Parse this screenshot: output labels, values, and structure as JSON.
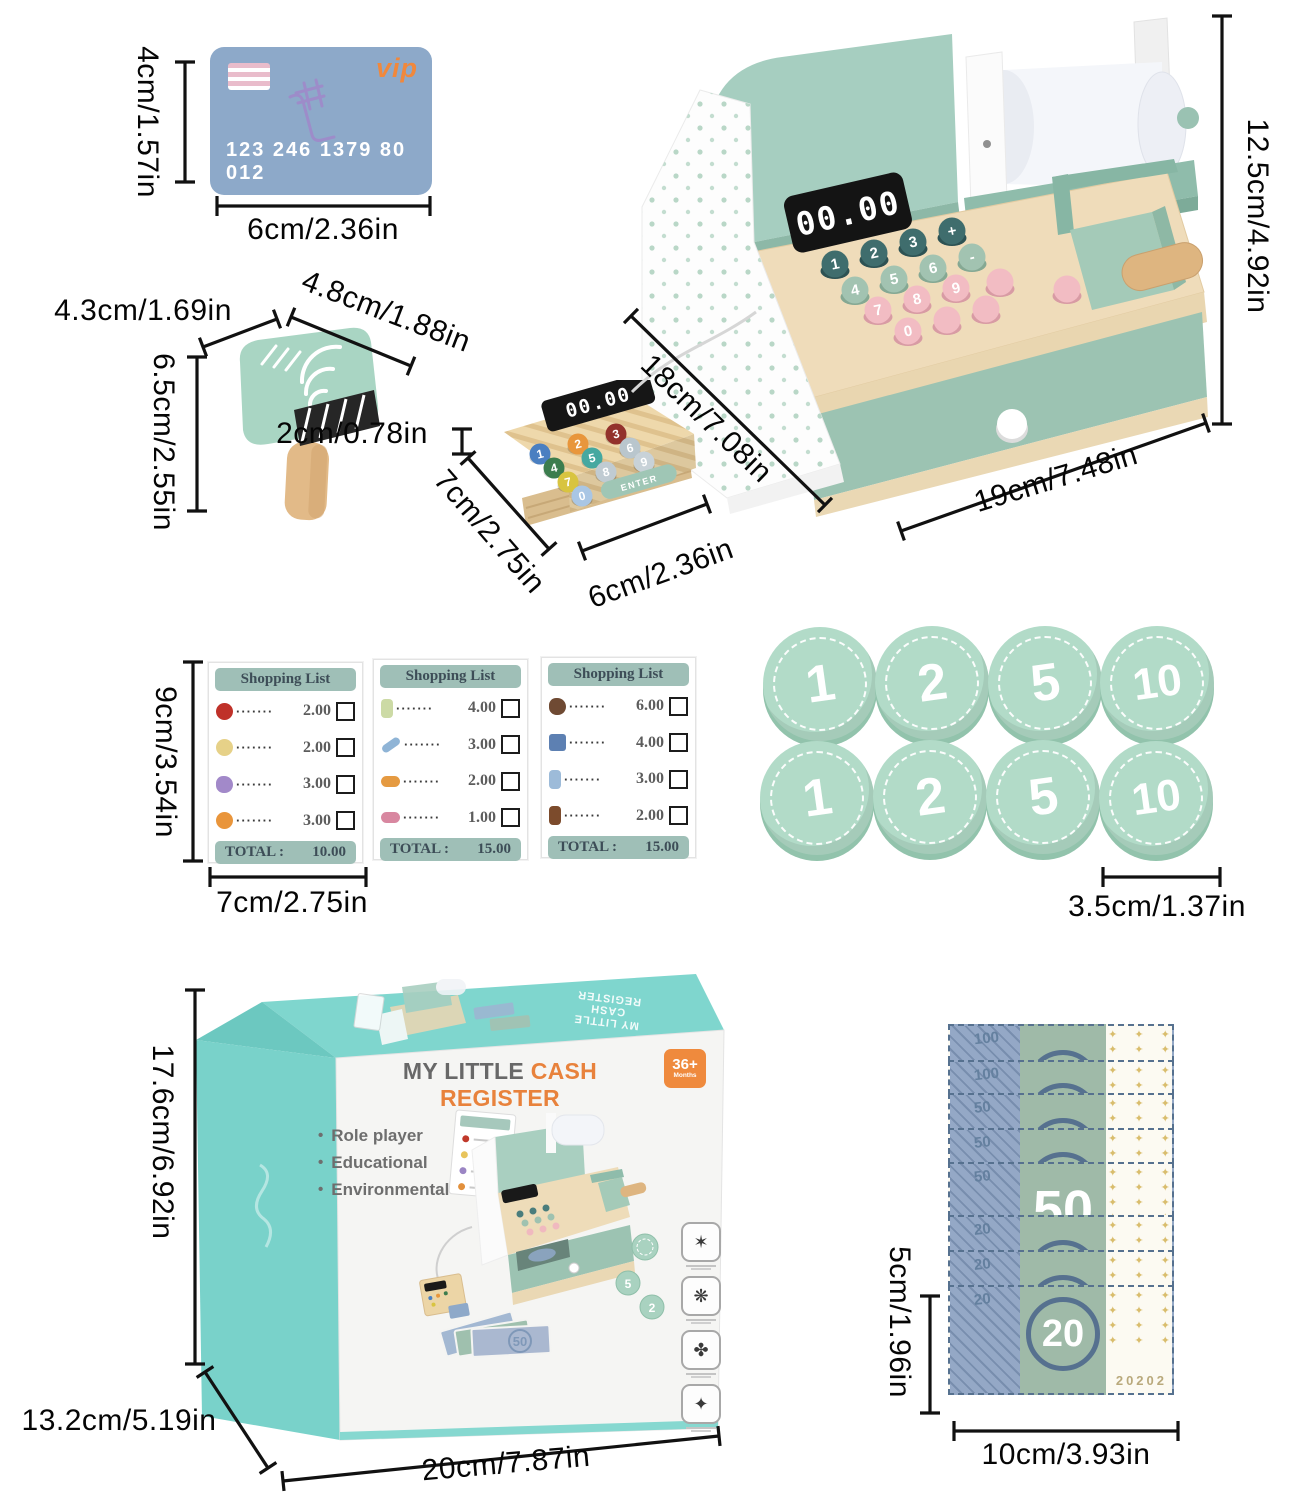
{
  "dims": {
    "card_h": "4cm/1.57in",
    "card_w": "6cm/2.36in",
    "reg_h": "12.5cm/4.92in",
    "reg_d": "18cm/7.08in",
    "reg_w": "19cm/7.48in",
    "scan_d": "4.3cm/1.69in",
    "scan_w": "4.8cm/1.88in",
    "scan_h": "6.5cm/2.55in",
    "scan_handle": "2cm/0.78in",
    "term_d": "7cm/2.75in",
    "term_w": "6cm/2.36in",
    "list_h": "9cm/3.54in",
    "list_w": "7cm/2.75in",
    "coin_d": "3.5cm/1.37in",
    "box_h": "17.6cm/6.92in",
    "box_d": "13.2cm/5.19in",
    "box_w": "20cm/7.87in",
    "money_h": "5cm/1.96in",
    "money_w": "10cm/3.93in"
  },
  "card": {
    "vip": "vip",
    "numbers": "123 246 1379 80 012"
  },
  "register": {
    "display": "00.00",
    "keys": [
      {
        "color": "#3f6d6d",
        "edge": "#2d5253",
        "digits": [
          "1",
          "2",
          "3",
          "+"
        ]
      },
      {
        "color": "#a2c3b1",
        "edge": "#85a893",
        "digits": [
          "4",
          "5",
          "6",
          "-"
        ]
      },
      {
        "color": "#f2bcc3",
        "edge": "#d89ba4",
        "digits": [
          "7",
          "8",
          "9"
        ]
      },
      {
        "color": "#f2bcc3",
        "edge": "#d89ba4",
        "digits": [
          "0",
          "",
          ""
        ]
      },
      {
        "color": "#f2bcc3",
        "edge": "#d89ba4",
        "digits": [
          "",
          ""
        ]
      }
    ]
  },
  "terminal": {
    "display": "00.00",
    "enter": "ENTER",
    "keys": [
      {
        "d": "1",
        "c": "#4a7fc1"
      },
      {
        "d": "2",
        "c": "#e8963c"
      },
      {
        "d": "3",
        "c": "#93322c"
      },
      {
        "d": "4",
        "c": "#3c7d4e"
      },
      {
        "d": "5",
        "c": "#46a8a0"
      },
      {
        "d": "6",
        "c": "#b9c6cd"
      },
      {
        "d": "7",
        "c": "#d8c440"
      },
      {
        "d": "8",
        "c": "#c0cbd2"
      },
      {
        "d": "9",
        "c": "#c8d2d8"
      },
      {
        "d": "0",
        "c": "#a9c6e4"
      }
    ]
  },
  "shopping": {
    "lists": [
      {
        "title": "Shopping List",
        "total_label": "TOTAL :",
        "total": "10.00",
        "items": [
          {
            "icon": "apple-icon",
            "color": "#bf3129",
            "shape": "circle",
            "price": "2.00"
          },
          {
            "icon": "lemon-icon",
            "color": "#e6d188",
            "shape": "circle",
            "price": "2.00"
          },
          {
            "icon": "grapes-icon",
            "color": "#a289c9",
            "shape": "blob",
            "price": "3.00"
          },
          {
            "icon": "orange-icon",
            "color": "#e9953b",
            "shape": "circle",
            "price": "3.00"
          }
        ]
      },
      {
        "title": "Shopping List",
        "total_label": "TOTAL :",
        "total": "15.00",
        "items": [
          {
            "icon": "soap-bottle-icon",
            "color": "#ccdaa5",
            "shape": "tall",
            "price": "4.00"
          },
          {
            "icon": "toothpaste-icon",
            "color": "#8fb4d6",
            "shape": "bar",
            "price": "3.00"
          },
          {
            "icon": "soap-bar-icon",
            "color": "#e59a41",
            "shape": "wide",
            "price": "2.00"
          },
          {
            "icon": "sponge-icon",
            "color": "#d887a0",
            "shape": "wide",
            "price": "1.00"
          }
        ]
      },
      {
        "title": "Shopping List",
        "total_label": "TOTAL :",
        "total": "15.00",
        "items": [
          {
            "icon": "muffin-icon",
            "color": "#6f4a33",
            "shape": "blob",
            "price": "6.00"
          },
          {
            "icon": "snack-bag-icon",
            "color": "#5d80b2",
            "shape": "square",
            "price": "4.00"
          },
          {
            "icon": "milk-icon",
            "color": "#9dbbd9",
            "shape": "tall",
            "price": "3.00"
          },
          {
            "icon": "coffee-icon",
            "color": "#7c4b2c",
            "shape": "tall",
            "price": "2.00"
          }
        ]
      }
    ]
  },
  "coins": {
    "rows": [
      [
        "1",
        "2",
        "5",
        "10"
      ],
      [
        "1",
        "2",
        "5",
        "10"
      ]
    ]
  },
  "money": {
    "serial": "20202",
    "bills": [
      {
        "denom": "100"
      },
      {
        "denom": "100"
      },
      {
        "denom": "50"
      },
      {
        "denom": "50"
      },
      {
        "denom": "50",
        "big": "50"
      },
      {
        "denom": "20"
      },
      {
        "denom": "20"
      },
      {
        "denom": "20",
        "big": "20"
      }
    ]
  },
  "box": {
    "title_prefix": "MY LITTLE",
    "title_accent": "CASH REGISTER",
    "age": "36+",
    "age_sub": "Months",
    "features": [
      "Role player",
      "Educational",
      "Environmental"
    ],
    "top_lines": [
      "MY LITTLE",
      "CASH",
      "REGISTER"
    ],
    "illustration": {
      "bill": "50",
      "coins": [
        "5",
        "2"
      ]
    }
  }
}
